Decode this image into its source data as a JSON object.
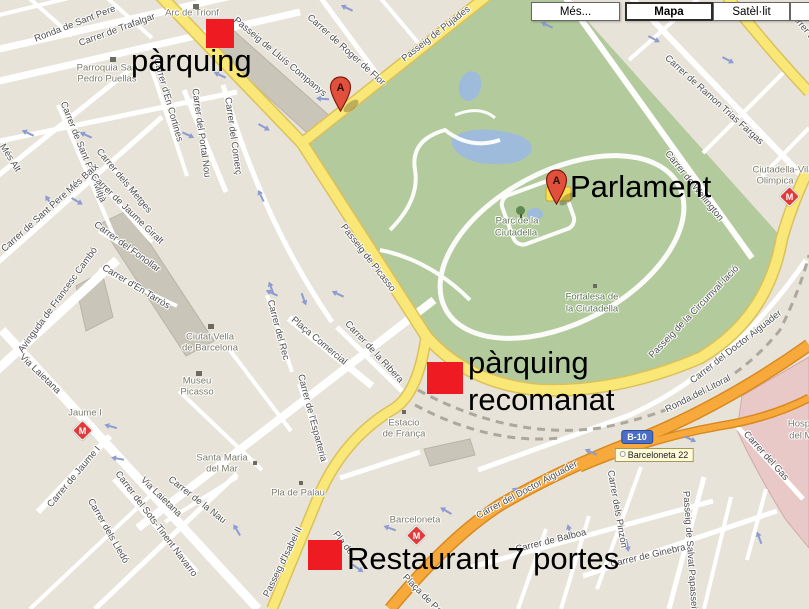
{
  "controls": {
    "buttons": [
      {
        "label": "Més...",
        "selected": false
      },
      {
        "label": "Mapa",
        "selected": true
      },
      {
        "label": "Satèl·lit",
        "selected": false
      },
      {
        "label": "Relleu",
        "selected": false
      }
    ]
  },
  "annotations": {
    "marker_color": "#EE1B23",
    "markers": [
      {
        "x": 206,
        "y": 19,
        "w": 28,
        "h": 29
      },
      {
        "x": 427,
        "y": 362,
        "w": 36,
        "h": 32
      },
      {
        "x": 308,
        "y": 540,
        "w": 34,
        "h": 30
      }
    ],
    "texts": [
      {
        "lines": [
          "pàrquing"
        ],
        "x": 131,
        "y": 42
      },
      {
        "lines": [
          "Parlament"
        ],
        "x": 570,
        "y": 168
      },
      {
        "lines": [
          "pàrquing",
          "recomanat"
        ],
        "x": 468,
        "y": 344
      },
      {
        "lines": [
          "Restaurant 7 portes"
        ],
        "x": 347,
        "y": 540
      }
    ]
  },
  "map": {
    "pins": [
      {
        "letter": "A",
        "x": 340,
        "y": 111
      },
      {
        "letter": "A",
        "x": 556,
        "y": 204
      }
    ],
    "metro_stations": [
      {
        "name": "Jaume I",
        "x": 82,
        "y": 430
      },
      {
        "name": "Barceloneta",
        "x": 416,
        "y": 535
      },
      {
        "name": "Ciutadella-Vila Olímpica",
        "x": 789,
        "y": 196
      }
    ],
    "badges": [
      {
        "type": "motorway",
        "text": "B-10",
        "x": 637,
        "y": 437
      },
      {
        "type": "exit",
        "text": "Barceloneta 22",
        "x": 654,
        "y": 455
      }
    ],
    "labels": [
      {
        "t": "Ronda de Sant Pere",
        "x": 75,
        "y": 24,
        "r": -21
      },
      {
        "t": "Carrer de Trafalgar",
        "x": 117,
        "y": 30,
        "r": -20
      },
      {
        "t": "Passeig de Lluís Companys",
        "x": 280,
        "y": 57,
        "r": 40
      },
      {
        "t": "Carrer de Roger de Flor",
        "x": 346,
        "y": 50,
        "r": 42
      },
      {
        "t": "Carrer d'En Cortines",
        "x": 168,
        "y": 100,
        "r": 74
      },
      {
        "t": "Carrer del Portal Nou",
        "x": 201,
        "y": 133,
        "r": 82
      },
      {
        "t": "Carrer del Comerç",
        "x": 233,
        "y": 136,
        "r": 82
      },
      {
        "t": "Carrer de Sant Pere Mitjà",
        "x": 83,
        "y": 152,
        "r": 68
      },
      {
        "t": "Més Alt",
        "x": 10,
        "y": 158,
        "r": 58
      },
      {
        "t": "Carrer de Sant Pere Més Baix",
        "x": 50,
        "y": 208,
        "r": -42
      },
      {
        "t": "Carrer dels Metges",
        "x": 124,
        "y": 181,
        "r": 50
      },
      {
        "t": "Carrer de Jaume Giralt",
        "x": 127,
        "y": 209,
        "r": 44
      },
      {
        "t": "Carrer del Fonollar",
        "x": 127,
        "y": 247,
        "r": 36
      },
      {
        "t": "Carrer d'En Tarròs",
        "x": 136,
        "y": 287,
        "r": 31
      },
      {
        "t": "Avinguda de Francesc Cambó",
        "x": 58,
        "y": 300,
        "r": -54
      },
      {
        "t": "Via Laietana",
        "x": 40,
        "y": 374,
        "r": 44
      },
      {
        "t": "Via Laietana",
        "x": 161,
        "y": 497,
        "r": 44
      },
      {
        "t": "Carrer de Jaume I",
        "x": 74,
        "y": 477,
        "r": -50
      },
      {
        "t": "Carrer dels Lledó",
        "x": 108,
        "y": 531,
        "r": 60
      },
      {
        "t": "Carrer del Sots-Tinent Navarro",
        "x": 156,
        "y": 524,
        "r": 53
      },
      {
        "t": "Carrer de la Nau",
        "x": 197,
        "y": 500,
        "r": 38
      },
      {
        "t": "Carrer del Rec",
        "x": 278,
        "y": 330,
        "r": 75
      },
      {
        "t": "Plaça Comercial",
        "x": 319,
        "y": 341,
        "r": 40
      },
      {
        "t": "Carrer de la Ribera",
        "x": 374,
        "y": 352,
        "r": 47
      },
      {
        "t": "Carrer de l'Esparteria",
        "x": 312,
        "y": 418,
        "r": 75
      },
      {
        "t": "Passeig d'Isabel II",
        "x": 283,
        "y": 562,
        "r": -64
      },
      {
        "t": "Pla de",
        "x": 343,
        "y": 543,
        "r": 52
      },
      {
        "t": "Plaça de Pau",
        "x": 424,
        "y": 596,
        "r": 45
      },
      {
        "t": "Carrer de Balboa",
        "x": 551,
        "y": 541,
        "r": -14
      },
      {
        "t": "Carrer dels Pinzón",
        "x": 617,
        "y": 509,
        "r": 80
      },
      {
        "t": "Carrer de Ginebra",
        "x": 648,
        "y": 556,
        "r": -13
      },
      {
        "t": "Passeig de Salvat Papasseit",
        "x": 690,
        "y": 551,
        "r": 86
      },
      {
        "t": "Carrer del Gas",
        "x": 766,
        "y": 456,
        "r": 48
      },
      {
        "t": "Ronda del Litoral",
        "x": 698,
        "y": 394,
        "r": -27
      },
      {
        "t": "Carrer del Doctor Aiguader",
        "x": 736,
        "y": 347,
        "r": -38
      },
      {
        "t": "Carrer del Doctor Aiguader",
        "x": 527,
        "y": 490,
        "r": -28
      },
      {
        "t": "Carrer de Wellington",
        "x": 694,
        "y": 186,
        "r": 51
      },
      {
        "t": "Carrer de Ramon Trias Fargas",
        "x": 714,
        "y": 100,
        "r": 42
      },
      {
        "t": "Passeig de Pujades",
        "x": 436,
        "y": 34,
        "r": -38
      },
      {
        "t": "Passeig de Picasso",
        "x": 368,
        "y": 258,
        "r": 52
      },
      {
        "t": "Passeig de la Circumval·lació",
        "x": 694,
        "y": 312,
        "r": -46
      },
      {
        "t": "Carrer de",
        "x": 803,
        "y": 27,
        "r": 50
      },
      {
        "t": "Arc de Trionf",
        "x": 192,
        "y": 13,
        "r": 0,
        "c": "poi"
      },
      {
        "t": "Parroquia San",
        "x": 107,
        "y": 68,
        "r": 0,
        "c": "poi"
      },
      {
        "t": "Pedro Puellas",
        "x": 107,
        "y": 79,
        "r": 0,
        "c": "poi"
      },
      {
        "t": "Ciutat Vella",
        "x": 210,
        "y": 337,
        "r": 0,
        "c": "poi"
      },
      {
        "t": "de Barcelona",
        "x": 210,
        "y": 348,
        "r": 0,
        "c": "poi"
      },
      {
        "t": "Museu",
        "x": 197,
        "y": 381,
        "r": 0,
        "c": "poi"
      },
      {
        "t": "Picasso",
        "x": 197,
        "y": 392,
        "r": 0,
        "c": "poi"
      },
      {
        "t": "Santa Maria",
        "x": 222,
        "y": 458,
        "r": 0,
        "c": "poi"
      },
      {
        "t": "del Mar",
        "x": 222,
        "y": 469,
        "r": 0,
        "c": "poi"
      },
      {
        "t": "Jaume I",
        "x": 85,
        "y": 413,
        "r": 0,
        "c": "poi"
      },
      {
        "t": "Pla de Palau",
        "x": 298,
        "y": 493,
        "r": 0,
        "c": "poi"
      },
      {
        "t": "Barceloneta",
        "x": 415,
        "y": 520,
        "r": 0,
        "c": "poi"
      },
      {
        "t": "Estacio",
        "x": 404,
        "y": 423,
        "r": 0,
        "c": "poi"
      },
      {
        "t": "de França",
        "x": 404,
        "y": 434,
        "r": 0,
        "c": "poi"
      },
      {
        "t": "Parc de la",
        "x": 517,
        "y": 221,
        "r": 0,
        "c": "park"
      },
      {
        "t": "Ciutadella",
        "x": 516,
        "y": 233,
        "r": 0,
        "c": "park"
      },
      {
        "t": "Fortalesa de",
        "x": 592,
        "y": 297,
        "r": 0,
        "c": "park"
      },
      {
        "t": "la Ciutadella",
        "x": 592,
        "y": 309,
        "r": 0,
        "c": "park"
      },
      {
        "t": "Ciutadella-Vila",
        "x": 783,
        "y": 170,
        "r": 0,
        "c": "poi"
      },
      {
        "t": "Olimpica",
        "x": 775,
        "y": 181,
        "r": 0,
        "c": "poi"
      },
      {
        "t": "Hospital",
        "x": 805,
        "y": 424,
        "r": 0,
        "c": "poi"
      },
      {
        "t": "del Mar",
        "x": 805,
        "y": 436,
        "r": 0,
        "c": "poi"
      }
    ],
    "poi_icons": [
      {
        "type": "church",
        "x": 110,
        "y": 57
      },
      {
        "type": "monument",
        "x": 193,
        "y": 4
      },
      {
        "type": "hotel",
        "x": 208,
        "y": 324
      },
      {
        "type": "museum",
        "x": 196,
        "y": 371
      },
      {
        "type": "square",
        "x": 253,
        "y": 461
      },
      {
        "type": "square",
        "x": 299,
        "y": 481
      },
      {
        "type": "square",
        "x": 402,
        "y": 410
      },
      {
        "type": "square",
        "x": 593,
        "y": 284
      },
      {
        "type": "tree",
        "x": 516,
        "y": 206
      }
    ],
    "arrows": [
      [
        30,
        134,
        205
      ],
      [
        88,
        136,
        205
      ],
      [
        186,
        134,
        25
      ],
      [
        222,
        76,
        205
      ],
      [
        262,
        126,
        30
      ],
      [
        325,
        99,
        185
      ],
      [
        349,
        9,
        205
      ],
      [
        549,
        26,
        205
      ],
      [
        652,
        38,
        28
      ],
      [
        726,
        59,
        28
      ],
      [
        50,
        203,
        240
      ],
      [
        75,
        200,
        30
      ],
      [
        262,
        198,
        245
      ],
      [
        272,
        290,
        250
      ],
      [
        303,
        297,
        70
      ],
      [
        274,
        294,
        205
      ],
      [
        340,
        295,
        205
      ],
      [
        113,
        427,
        195
      ],
      [
        120,
        459,
        190
      ],
      [
        238,
        532,
        240
      ],
      [
        448,
        512,
        210
      ],
      [
        356,
        567,
        35
      ],
      [
        392,
        529,
        200
      ],
      [
        570,
        533,
        255
      ],
      [
        627,
        543,
        80
      ],
      [
        688,
        438,
        25
      ],
      [
        593,
        453,
        205
      ],
      [
        520,
        492,
        205
      ],
      [
        760,
        540,
        250
      ]
    ]
  }
}
